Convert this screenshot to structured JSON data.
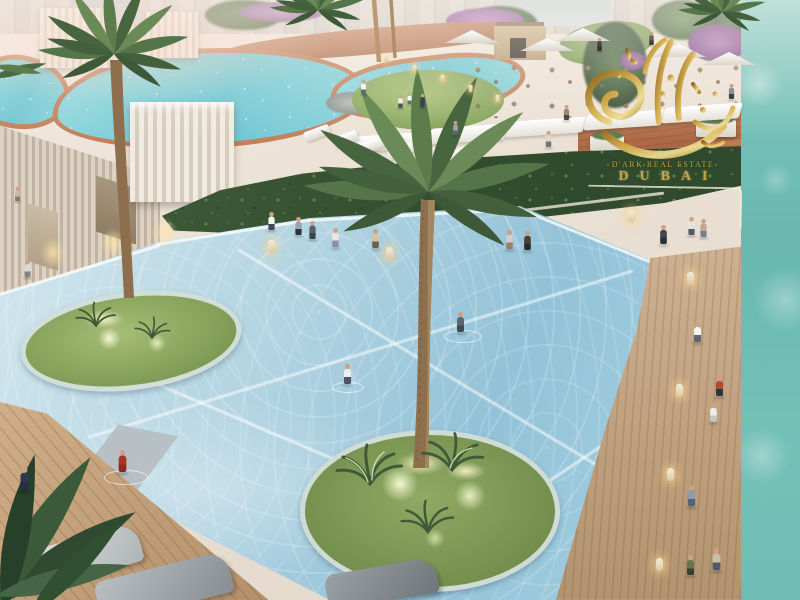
{
  "watermark": {
    "line1": "D'ARK REAL ESTATE",
    "line2": "DUBAI",
    "logo": "arabic-calligraphy-gold-icon",
    "gold_color": "#c9a23a"
  },
  "palette": {
    "main_pool_water": "#a9d0e0",
    "lagoon_water": "#6ec6d2",
    "sea_strip": "#6fbcb4",
    "plaza": "#ece2d6",
    "terracotta": "#b5714e",
    "lawn_green": "#8aa55e",
    "hedge_green": "#35502f",
    "wood_deck": "#c0a07c",
    "palm_green": "#5d7c4c",
    "watermark_gold": "#c9a23a"
  },
  "scene": {
    "people": [
      {
        "x": 14,
        "y": 200,
        "s": 0.7,
        "t": "#cbb9a6",
        "b": "#8d7b63"
      },
      {
        "x": 24,
        "y": 279,
        "s": 0.85,
        "t": "#d8d8da",
        "b": "#7e828c"
      },
      {
        "x": 360,
        "y": 93,
        "s": 0.7,
        "t": "#f4f4f2",
        "b": "#5f6d7e"
      },
      {
        "x": 397,
        "y": 106,
        "s": 0.65,
        "t": "#f0eee8",
        "b": "#4a5568"
      },
      {
        "x": 419,
        "y": 105,
        "s": 0.65,
        "t": "#3c4250",
        "b": "#3c4250"
      },
      {
        "x": 406,
        "y": 100,
        "s": 0.55,
        "t": "#ffffff",
        "b": "#666f7a"
      },
      {
        "x": 452,
        "y": 134,
        "s": 0.7,
        "t": "#9aa2ac",
        "b": "#5d6570"
      },
      {
        "x": 563,
        "y": 120,
        "s": 0.75,
        "t": "#a08873",
        "b": "#50483c"
      },
      {
        "x": 596,
        "y": 49,
        "s": 0.65,
        "t": "#4a4640",
        "b": "#36332e"
      },
      {
        "x": 648,
        "y": 43,
        "s": 0.65,
        "t": "#6e6258",
        "b": "#453f38"
      },
      {
        "x": 728,
        "y": 99,
        "s": 0.75,
        "t": "#8e8e92",
        "b": "#3e4246"
      },
      {
        "x": 268,
        "y": 233,
        "s": 0.9,
        "t": "#f2f2f0",
        "b": "#3f4a5a"
      },
      {
        "x": 295,
        "y": 238,
        "s": 0.9,
        "t": "#9aa3b0",
        "b": "#2c3340"
      },
      {
        "x": 309,
        "y": 242,
        "s": 0.9,
        "t": "#57606e",
        "b": "#3a4150"
      },
      {
        "x": 332,
        "y": 251,
        "s": 0.95,
        "t": "#e8e6e0",
        "b": "#8a94a2"
      },
      {
        "x": 372,
        "y": 252,
        "s": 0.95,
        "t": "#d9c2a4",
        "b": "#6e5f4c"
      },
      {
        "x": 506,
        "y": 253,
        "s": 0.95,
        "t": "#cfcfcf",
        "b": "#97836c"
      },
      {
        "x": 524,
        "y": 254,
        "s": 0.95,
        "t": "#45403a",
        "b": "#2e2b27"
      },
      {
        "x": 545,
        "y": 148,
        "s": 0.8,
        "t": "#ded6ca",
        "b": "#6f7680"
      },
      {
        "x": 660,
        "y": 248,
        "s": 0.95,
        "t": "#3f4754",
        "b": "#2a3038"
      },
      {
        "x": 688,
        "y": 238,
        "s": 0.9,
        "t": "#e6e3dc",
        "b": "#555c66"
      },
      {
        "x": 700,
        "y": 240,
        "s": 0.9,
        "t": "#c2a794",
        "b": "#77828e"
      },
      {
        "x": 694,
        "y": 347,
        "s": 1.0,
        "t": "#f5f5f3",
        "b": "#5a6878"
      },
      {
        "x": 716,
        "y": 401,
        "s": 1.0,
        "t": "#b54a30",
        "b": "#2f3640"
      },
      {
        "x": 710,
        "y": 426,
        "s": 0.95,
        "t": "#ececea",
        "b": "#c9c9c5"
      },
      {
        "x": 688,
        "y": 512,
        "s": 1.05,
        "t": "#8c9cae",
        "b": "#566274"
      },
      {
        "x": 713,
        "y": 577,
        "s": 1.1,
        "t": "#cdbfa6",
        "b": "#4e5a6e"
      },
      {
        "x": 687,
        "y": 580,
        "s": 1.0,
        "t": "#68764c",
        "b": "#3a4030"
      },
      {
        "x": 457,
        "y": 337,
        "s": 1.0,
        "t": "#5b6673",
        "b": "#414a56"
      },
      {
        "x": 344,
        "y": 389,
        "s": 1.0,
        "t": "#efefed",
        "b": "#4c5664"
      },
      {
        "x": 119,
        "y": 479,
        "s": 1.1,
        "t": "#a83425",
        "b": "#8e2a1f"
      },
      {
        "x": 21,
        "y": 498,
        "s": 1.15,
        "t": "#2f3752",
        "b": "#272e46"
      }
    ],
    "bollards": [
      {
        "x": 628,
        "y": 210
      },
      {
        "x": 687,
        "y": 272
      },
      {
        "x": 676,
        "y": 384
      },
      {
        "x": 667,
        "y": 468
      },
      {
        "x": 656,
        "y": 558
      },
      {
        "x": 268,
        "y": 240
      },
      {
        "x": 386,
        "y": 247
      },
      {
        "x": 383,
        "y": 52,
        "s": 0.55
      },
      {
        "x": 411,
        "y": 62,
        "s": 0.55
      },
      {
        "x": 439,
        "y": 72,
        "s": 0.55
      },
      {
        "x": 467,
        "y": 82,
        "s": 0.55
      },
      {
        "x": 494,
        "y": 92,
        "s": 0.55
      }
    ],
    "canopies": [
      {
        "x": 352,
        "y": 134
      },
      {
        "x": 430,
        "y": 126
      },
      {
        "x": 508,
        "y": 119
      },
      {
        "x": 586,
        "y": 112
      },
      {
        "x": 664,
        "y": 105
      }
    ],
    "umbrellas": [
      {
        "x": 445,
        "y": 30
      },
      {
        "x": 520,
        "y": 38
      },
      {
        "x": 556,
        "y": 28
      },
      {
        "x": 652,
        "y": 44
      },
      {
        "x": 702,
        "y": 52
      }
    ],
    "sunbeds": [
      {
        "x": 304,
        "y": 128
      },
      {
        "x": 332,
        "y": 134
      },
      {
        "x": 360,
        "y": 140
      },
      {
        "x": 388,
        "y": 146
      },
      {
        "x": 418,
        "y": 149
      },
      {
        "x": 448,
        "y": 148
      }
    ],
    "wall_lights": [
      {
        "x": 40,
        "y": 238
      },
      {
        "x": 100,
        "y": 228
      },
      {
        "x": 152,
        "y": 218
      }
    ],
    "uplights": [
      {
        "x": 396,
        "y": 452,
        "w": 50
      },
      {
        "x": 446,
        "y": 462,
        "w": 40
      },
      {
        "x": 84,
        "y": 310,
        "w": 40
      }
    ],
    "ripples": [
      {
        "x": 444,
        "y": 330,
        "w": 36
      },
      {
        "x": 332,
        "y": 382,
        "w": 30
      },
      {
        "x": 104,
        "y": 470,
        "w": 42
      }
    ]
  }
}
